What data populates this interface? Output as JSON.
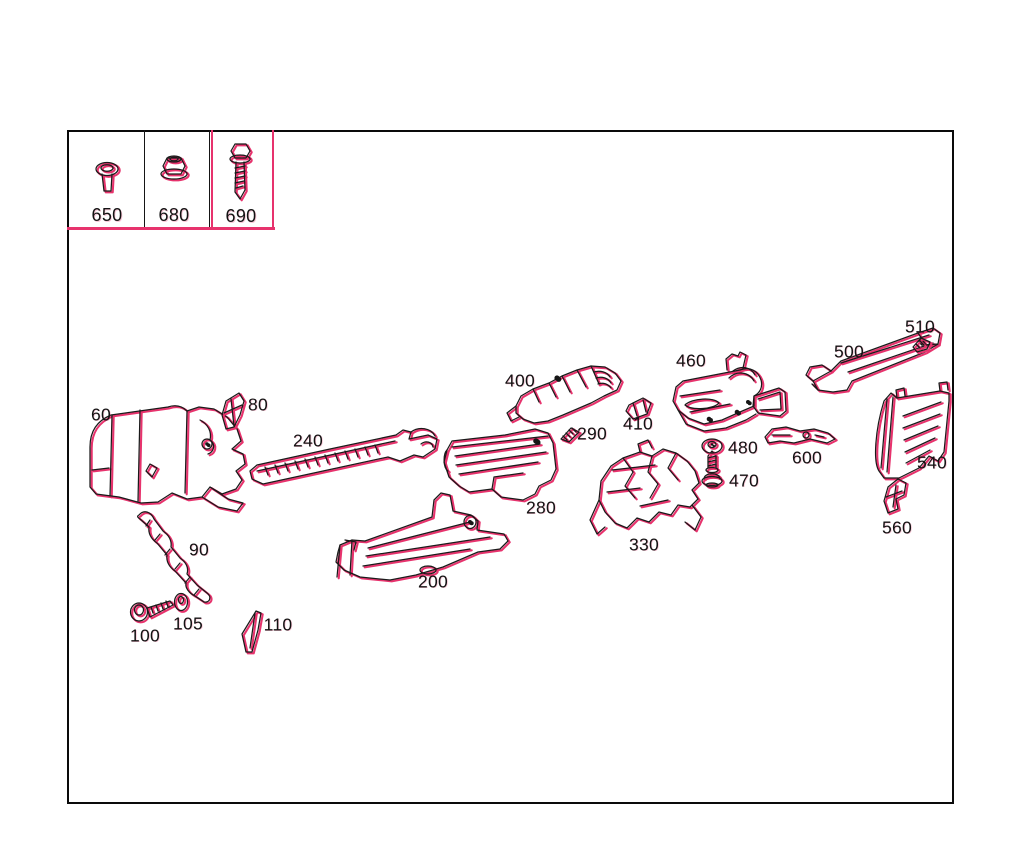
{
  "colors": {
    "background": "#ffffff",
    "line": "#1a1a1a",
    "highlight": "#e7336d"
  },
  "legend": {
    "items": [
      {
        "label": "650",
        "icon": "expansion-rivet-icon"
      },
      {
        "label": "680",
        "icon": "flange-nut-icon"
      },
      {
        "label": "690",
        "icon": "hex-screw-icon"
      }
    ]
  },
  "parts": [
    {
      "label": "60"
    },
    {
      "label": "80"
    },
    {
      "label": "90"
    },
    {
      "label": "100"
    },
    {
      "label": "105"
    },
    {
      "label": "110"
    },
    {
      "label": "200"
    },
    {
      "label": "240"
    },
    {
      "label": "280"
    },
    {
      "label": "290"
    },
    {
      "label": "330"
    },
    {
      "label": "400"
    },
    {
      "label": "410"
    },
    {
      "label": "460"
    },
    {
      "label": "470"
    },
    {
      "label": "480"
    },
    {
      "label": "500"
    },
    {
      "label": "510"
    },
    {
      "label": "540"
    },
    {
      "label": "560"
    },
    {
      "label": "600"
    }
  ]
}
